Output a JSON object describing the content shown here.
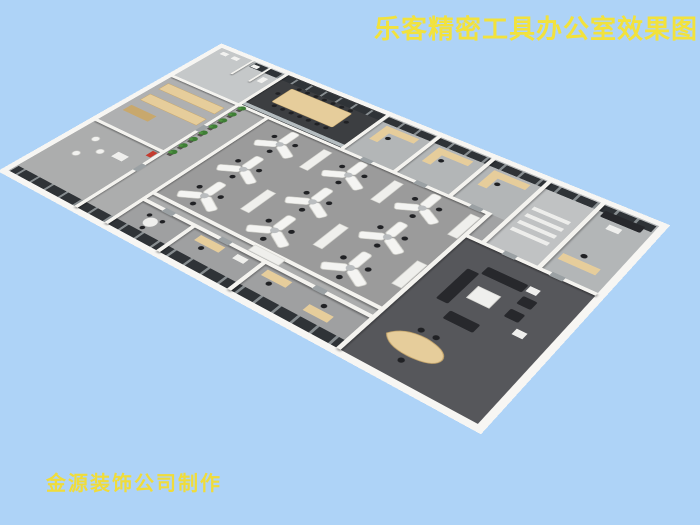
{
  "title": {
    "text": "乐客精密工具办公室效果图"
  },
  "watermark": {
    "text": "金源装饰公司制作"
  },
  "colors": {
    "background": "#AED3F7",
    "title-text": "#F2E23C",
    "watermark-text": "#F0DC3A",
    "slab": "#F7F6F3",
    "wall": "#F4F3EF",
    "floor-base": "#A2A3A4",
    "floor-open": "#9B9B9B",
    "floor-office": "#B3B6B7",
    "floor-conference": "#3C3E41",
    "floor-lounge": "#56575B",
    "floor-corridor": "#ACADAD",
    "floor-washroom": "#C5C8C9",
    "floor-storage": "#AFB0B1",
    "floor-steps": "#C0C2C3",
    "floor-srooms": "#9FA0A1",
    "window-dark": "#2F3337",
    "window-frame": "#878D90",
    "glass": "#C9D2D6",
    "wood": "#E6CD9B",
    "wood-dark": "#C8A86D",
    "desk-white": "#F4F4F2",
    "cabinet-white": "#EFEFEC",
    "chair-black": "#202124",
    "sofa-black": "#27282C",
    "plant-green": "#3E7D35",
    "plant-light": "#4E9340",
    "table-white": "#EFEFED",
    "door-gray": "#9BA1A4",
    "accent-red": "#C43B2F"
  }
}
